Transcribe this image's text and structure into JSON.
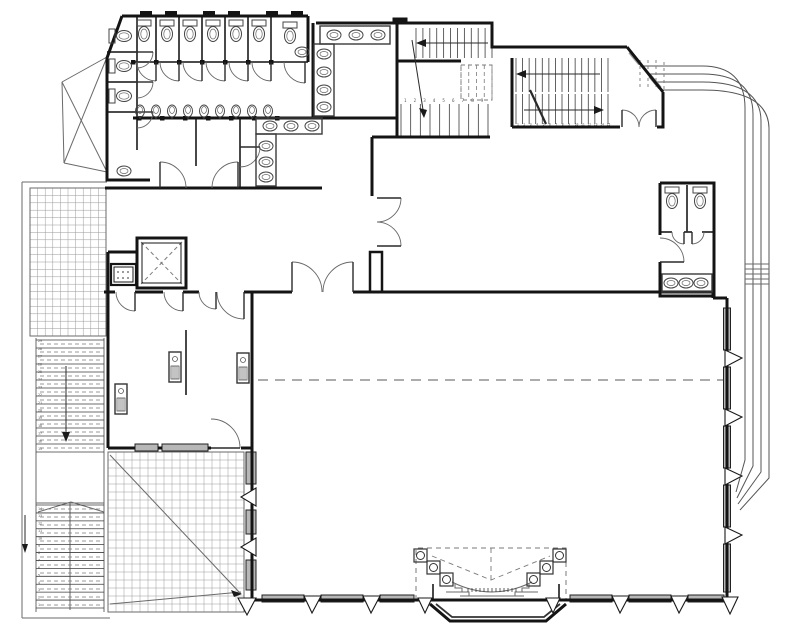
{
  "colors": {
    "wall": "#141414",
    "medium": "#333333",
    "thin": "#6a6a6a",
    "dash": "#7a7a7a",
    "canopy": "#555555",
    "grid": "#9a9a9a",
    "sill": "#b7b7b7",
    "hatchgray": "#999999",
    "number": "#555555",
    "background": "#ffffff"
  },
  "plan": {
    "walls": [
      "M122,16 H308",
      "M122,16 L107,58 V180 H150",
      "M308,16 V62",
      "M313,23 V118",
      "M316,23 H492 V47 H627",
      "M627,47 L663,92",
      "M663,92 V112",
      "M133,118 H312",
      "M312,118 H397",
      "M105,188 H322",
      "M397,23 V137",
      "M397,61 H461",
      "M372,137 H490",
      "M372,137 V196",
      "M512,58 V127",
      "M512,127 H620",
      "M657,127 L663,127 L663,112",
      "M660,183 H714 V296 H660 V262",
      "M660,235 V183",
      "M252,292 H292",
      "M353,292 H713",
      "M713,292 V298",
      "M713,298 H727",
      "M727,298 V600",
      "M252,600 H727",
      "M252,292 V448",
      "M252,448 V600",
      "M104,292 H115",
      "M135,292 H163",
      "M183,292 H199",
      "M244,292 H252",
      "M108,252 V292",
      "M108,252 H137",
      "M108,292 V448",
      "M108,448 H135",
      "M158,448 H162",
      "M208,448 H211",
      "M241,448 H252",
      "M430,604 L450,621 H546 L566,604"
    ],
    "med": [
      "M133,62 H308",
      "M156,16 V62",
      "M179,16 V62",
      "M202,16 V62",
      "M225,16 V62",
      "M248,16 V62",
      "M271,16 V62",
      "M107,52 H137",
      "M107,82 H137",
      "M107,112 H137",
      "M137,16 V150",
      "M196,118 V166",
      "M240,118 V188",
      "M186,330 V395",
      "M687,185 V232",
      "M660,232 H672",
      "M684,232 H692",
      "M702,232 H714",
      "M433,584 V601",
      "M559,584 V601",
      "M436,604 L452,617 H544 L560,604"
    ],
    "thin": [
      "M22,182 H107",
      "M22,182 V618",
      "M22,618 H110",
      "M30,336 H106",
      "M36,338 V612",
      "M104,338 V612",
      "M38,512 L71,502",
      "M104,512 L71,502",
      "M36,503 H104",
      "M70,503 V610",
      "M110,455 L241,594",
      "M110,604 L241,592",
      "M62,82 L107,57",
      "M62,82 L64,163",
      "M64,163 L107,172",
      "M62,82 L107,172",
      "M107,57 L64,163",
      "M452,582 Q492,602 532,582",
      "M460,596 H524",
      "M446,592 H468",
      "M516,592 H538",
      "M455,584 V588 H462 V592 H469 V596",
      "M529,584 V588 H522 V592 H515 V596",
      "M745,264 H769",
      "M745,269 H769",
      "M745,274 H769",
      "M745,279 H769",
      "M745,284 H769"
    ],
    "graythick": [
      "M630,52 L640,64",
      "M650,76 L660,88"
    ],
    "canopy": [
      "M642,66 H702 Q745,66 745,108 V460 L736,492",
      "M648,74 H702 Q753,74 753,114 V466 L737,498",
      "M654,82 H702 Q761,82 761,121 V472 L738,504",
      "M660,90 H702 Q769,90 769,129 V478 L740,510"
    ],
    "dashed": [
      {
        "d": "M258,380 H724",
        "da": "10,7",
        "w": 1.2
      },
      {
        "d": "M141,242 L182,284",
        "da": "4,3",
        "w": 1
      },
      {
        "d": "M182,242 L141,284",
        "da": "4,3",
        "w": 1
      },
      {
        "d": "M416,600 V548 H566 V600",
        "da": "5,4",
        "w": 1
      },
      {
        "d": "M491,548 V584",
        "da": "5,4",
        "w": 0.9
      },
      {
        "d": "M432,556 L491,580 L550,556",
        "da": "5,4",
        "w": 0.9
      },
      {
        "d": "M640,60 V90",
        "da": "3,3",
        "w": 0.9
      },
      {
        "d": "M648,60 V90",
        "da": "3,3",
        "w": 0.9
      },
      {
        "d": "M656,60 V90",
        "da": "3,3",
        "w": 0.9
      },
      {
        "d": "M664,62 V90",
        "da": "3,3",
        "w": 0.9
      },
      {
        "d": "M461,65 H492 V100 H461 Z",
        "da": "4,3",
        "w": 0.9
      }
    ],
    "grids": [
      {
        "x": 30,
        "y": 188,
        "w": 76,
        "h": 148,
        "sx": 7.6,
        "sy": 7.4
      },
      {
        "x": 108,
        "y": 452,
        "w": 136,
        "h": 160,
        "sx": 8,
        "sy": 8
      }
    ],
    "stairs": [
      {
        "x": 416,
        "y": 28,
        "w": 76,
        "h": 30,
        "n": 12,
        "dir": "v"
      },
      {
        "x": 461,
        "y": 65,
        "w": 31,
        "h": 35,
        "n": 5,
        "dir": "v",
        "dash": true
      },
      {
        "x": 401,
        "y": 104,
        "w": 87,
        "h": 33,
        "n": 10,
        "dir": "v"
      },
      {
        "x": 516,
        "y": 58,
        "w": 92,
        "h": 34,
        "n": 15,
        "dir": "v"
      },
      {
        "x": 516,
        "y": 94,
        "w": 92,
        "h": 30,
        "n": 15,
        "dir": "v"
      },
      {
        "x": 36,
        "y": 340,
        "w": 68,
        "h": 112,
        "n": 15,
        "dir": "h"
      },
      {
        "x": 40,
        "y": 344,
        "w": 60,
        "h": 104,
        "n": 14,
        "dir": "h",
        "dash": true
      },
      {
        "x": 36,
        "y": 505,
        "w": 68,
        "h": 103,
        "n": 14,
        "dir": "h"
      },
      {
        "x": 40,
        "y": 509,
        "w": 60,
        "h": 96,
        "n": 13,
        "dir": "h",
        "dash": true
      },
      {
        "x": 468,
        "y": 588,
        "w": 48,
        "h": 4,
        "n": 13,
        "dir": "v"
      }
    ],
    "doors": [
      [
        156,
        62,
        19,
        90,
        180
      ],
      [
        179,
        62,
        19,
        90,
        180
      ],
      [
        202,
        62,
        19,
        90,
        180
      ],
      [
        225,
        62,
        19,
        90,
        180
      ],
      [
        248,
        62,
        19,
        90,
        180
      ],
      [
        271,
        62,
        19,
        90,
        180
      ],
      [
        305,
        62,
        21,
        90,
        180
      ],
      [
        137,
        52,
        16,
        0,
        90
      ],
      [
        137,
        82,
        16,
        0,
        90
      ],
      [
        137,
        112,
        16,
        0,
        90
      ],
      [
        160,
        188,
        26,
        270,
        0
      ],
      [
        238,
        188,
        26,
        270,
        180
      ],
      [
        240,
        147,
        20,
        0,
        90
      ],
      [
        377,
        198,
        24,
        0,
        90
      ],
      [
        377,
        246,
        24,
        0,
        270
      ],
      [
        622,
        127,
        17,
        270,
        0
      ],
      [
        656,
        127,
        17,
        270,
        180
      ],
      [
        684,
        232,
        12,
        90,
        180
      ],
      [
        692,
        232,
        12,
        90,
        0
      ],
      [
        660,
        262,
        24,
        0,
        270
      ],
      [
        292,
        292,
        30,
        270,
        0
      ],
      [
        353,
        292,
        30,
        270,
        180
      ],
      [
        135,
        292,
        19,
        90,
        180
      ],
      [
        183,
        292,
        19,
        90,
        180
      ],
      [
        244,
        292,
        27,
        90,
        180
      ],
      [
        216,
        292,
        17,
        90,
        180
      ],
      [
        211,
        448,
        29,
        0,
        270
      ]
    ],
    "toilets_up": [
      [
        144,
        30
      ],
      [
        167,
        30
      ],
      [
        190,
        30
      ],
      [
        213,
        30
      ],
      [
        236,
        30
      ],
      [
        259,
        30
      ],
      [
        290,
        32
      ],
      [
        672,
        197
      ],
      [
        700,
        197
      ]
    ],
    "toilets_right": [
      [
        120,
        36
      ],
      [
        120,
        66
      ],
      [
        120,
        96
      ]
    ],
    "urinals": {
      "y": 111,
      "xs": [
        140,
        156,
        172,
        188,
        204,
        220,
        236,
        252,
        268
      ]
    },
    "counters": [
      [
        256,
        118,
        66,
        16
      ],
      [
        256,
        134,
        20,
        52
      ],
      [
        320,
        26,
        70,
        18
      ],
      [
        314,
        44,
        20,
        72
      ],
      [
        662,
        274,
        50,
        18
      ]
    ],
    "sinks": [
      [
        270,
        126
      ],
      [
        291,
        126
      ],
      [
        312,
        126
      ],
      [
        266,
        146
      ],
      [
        266,
        162
      ],
      [
        266,
        177
      ],
      [
        334,
        35
      ],
      [
        356,
        35
      ],
      [
        378,
        35
      ],
      [
        324,
        54
      ],
      [
        324,
        72
      ],
      [
        324,
        90
      ],
      [
        324,
        107
      ],
      [
        671,
        283
      ],
      [
        686,
        283
      ],
      [
        701,
        283
      ],
      [
        302,
        52
      ]
    ],
    "units": [
      [
        115,
        384
      ],
      [
        169,
        352
      ],
      [
        237,
        353
      ]
    ],
    "rects": [
      {
        "x": 137,
        "y": 238,
        "w": 49,
        "h": 50,
        "sw": 3
      },
      {
        "x": 142,
        "y": 243,
        "w": 39,
        "h": 40,
        "sw": 1
      },
      {
        "x": 370,
        "y": 252,
        "w": 12,
        "h": 40,
        "sw": 2.5
      },
      {
        "x": 111,
        "y": 264,
        "w": 25,
        "h": 21,
        "sw": 2.2
      },
      {
        "x": 114,
        "y": 267,
        "w": 19,
        "h": 15,
        "sw": 1
      },
      {
        "x": 393,
        "y": 18,
        "w": 14,
        "h": 6,
        "sw": 1,
        "fill": "#141414"
      }
    ],
    "jambs": [
      [
        131,
        60
      ],
      [
        154,
        60
      ],
      [
        177,
        60
      ],
      [
        200,
        60
      ],
      [
        223,
        60
      ],
      [
        246,
        60
      ],
      [
        269,
        60
      ],
      [
        137,
        116
      ],
      [
        160,
        116
      ],
      [
        183,
        116
      ],
      [
        206,
        116
      ],
      [
        229,
        116
      ],
      [
        252,
        116
      ],
      [
        275,
        116
      ],
      [
        140,
        11
      ],
      [
        165,
        11
      ],
      [
        203,
        11
      ],
      [
        228,
        11
      ],
      [
        266,
        11
      ],
      [
        291,
        11
      ]
    ],
    "sills_h": [
      [
        262,
        304,
        595
      ],
      [
        321,
        363,
        595
      ],
      [
        380,
        414,
        595
      ],
      [
        570,
        612,
        595
      ],
      [
        629,
        671,
        595
      ],
      [
        688,
        724,
        595
      ],
      [
        135,
        158,
        444
      ],
      [
        162,
        208,
        444
      ]
    ],
    "sills_v": {
      "x": 723.5,
      "w": 7,
      "ys": [
        [
          308,
          350
        ],
        [
          367,
          409
        ],
        [
          426,
          468
        ],
        [
          485,
          527
        ],
        [
          544,
          592
        ]
      ]
    },
    "cols": [
      [
        246,
        452,
        10,
        32
      ],
      [
        246,
        510,
        10,
        24
      ],
      [
        246,
        560,
        10,
        30
      ]
    ],
    "white_polys": [
      [
        [
          304,
          596
        ],
        [
          321,
          596
        ],
        [
          312,
          613
        ]
      ],
      [
        [
          363,
          596
        ],
        [
          380,
          596
        ],
        [
          371,
          613
        ]
      ],
      [
        [
          612,
          596
        ],
        [
          629,
          596
        ],
        [
          620,
          613
        ]
      ],
      [
        [
          671,
          596
        ],
        [
          688,
          596
        ],
        [
          679,
          613
        ]
      ],
      [
        [
          418,
          598
        ],
        [
          432,
          598
        ],
        [
          425,
          613
        ]
      ],
      [
        [
          546,
          598
        ],
        [
          560,
          598
        ],
        [
          553,
          613
        ]
      ],
      [
        [
          256,
          598
        ],
        [
          238,
          598
        ],
        [
          247,
          615
        ]
      ],
      [
        [
          722,
          597
        ],
        [
          738,
          597
        ],
        [
          730,
          614
        ]
      ],
      [
        [
          725,
          350
        ],
        [
          725,
          367
        ],
        [
          742,
          358
        ]
      ],
      [
        [
          725,
          409
        ],
        [
          725,
          426
        ],
        [
          742,
          417
        ]
      ],
      [
        [
          725,
          468
        ],
        [
          725,
          485
        ],
        [
          742,
          476
        ]
      ],
      [
        [
          725,
          527
        ],
        [
          725,
          544
        ],
        [
          742,
          535
        ]
      ],
      [
        [
          256,
          488
        ],
        [
          256,
          506
        ],
        [
          241,
          497
        ]
      ],
      [
        [
          256,
          538
        ],
        [
          256,
          556
        ],
        [
          241,
          547
        ]
      ]
    ],
    "black_polys": [
      [
        [
          424,
          118
        ],
        [
          419,
          108
        ],
        [
          427,
          110
        ]
      ],
      [
        [
          416,
          43
        ],
        [
          426,
          39
        ],
        [
          426,
          47
        ]
      ],
      [
        [
          516,
          74
        ],
        [
          526,
          70
        ],
        [
          526,
          78
        ]
      ],
      [
        [
          604,
          110
        ],
        [
          594,
          106
        ],
        [
          594,
          114
        ]
      ],
      [
        [
          66,
          442
        ],
        [
          62,
          432
        ],
        [
          70,
          432
        ]
      ],
      [
        [
          25,
          553
        ],
        [
          22,
          544
        ],
        [
          28,
          544
        ]
      ],
      [
        [
          242,
          594
        ],
        [
          231,
          590
        ],
        [
          234,
          597
        ]
      ]
    ],
    "arrow_lines": [
      {
        "d": "M412,40 L424,116",
        "w": 1
      },
      {
        "d": "M424,43 H488",
        "w": 1
      },
      {
        "d": "M522,74 H600",
        "w": 1
      },
      {
        "d": "M524,110 H596",
        "w": 1
      },
      {
        "d": "M66,366 V432",
        "w": 1
      },
      {
        "d": "M25,515 V544",
        "w": 1
      },
      {
        "d": "M530,90 L546,124",
        "w": 2.2
      }
    ],
    "stage_cols": {
      "size": 13,
      "pos": [
        [
          414,
          549
        ],
        [
          427,
          561
        ],
        [
          440,
          573
        ],
        [
          553,
          549
        ],
        [
          540,
          561
        ],
        [
          527,
          573
        ]
      ]
    },
    "drain": {
      "x": 124,
      "y": 171
    },
    "numbers": [
      {
        "x": 404,
        "y": 102,
        "dx": 9.6,
        "dy": 0,
        "s": 4.2,
        "vals": [
          "1",
          "2",
          "3",
          "4",
          "5",
          "6",
          "7",
          "8",
          "9"
        ]
      },
      {
        "x": 517,
        "y": 125.5,
        "dx": 6.4,
        "dy": 0,
        "s": 3.1,
        "vals": [
          "1",
          "2",
          "3",
          "4",
          "5",
          "6",
          "7",
          "8",
          "9",
          "10",
          "11",
          "12",
          "13",
          "14",
          "15"
        ]
      },
      {
        "x": 38,
        "y": 450,
        "dx": 0,
        "dy": -7.7,
        "s": 3.4,
        "vals": [
          "15",
          "16",
          "17",
          "18",
          "19",
          "20",
          "21",
          "22",
          "23",
          "24",
          "25",
          "26",
          "27",
          "28",
          "29"
        ]
      },
      {
        "x": 38,
        "y": 606,
        "dx": 0,
        "dy": -7.4,
        "s": 3.4,
        "vals": [
          "1",
          "2",
          "3",
          "4",
          "5",
          "6",
          "7",
          "8",
          "9",
          "10",
          "11",
          "12",
          "13",
          "14"
        ]
      }
    ]
  }
}
